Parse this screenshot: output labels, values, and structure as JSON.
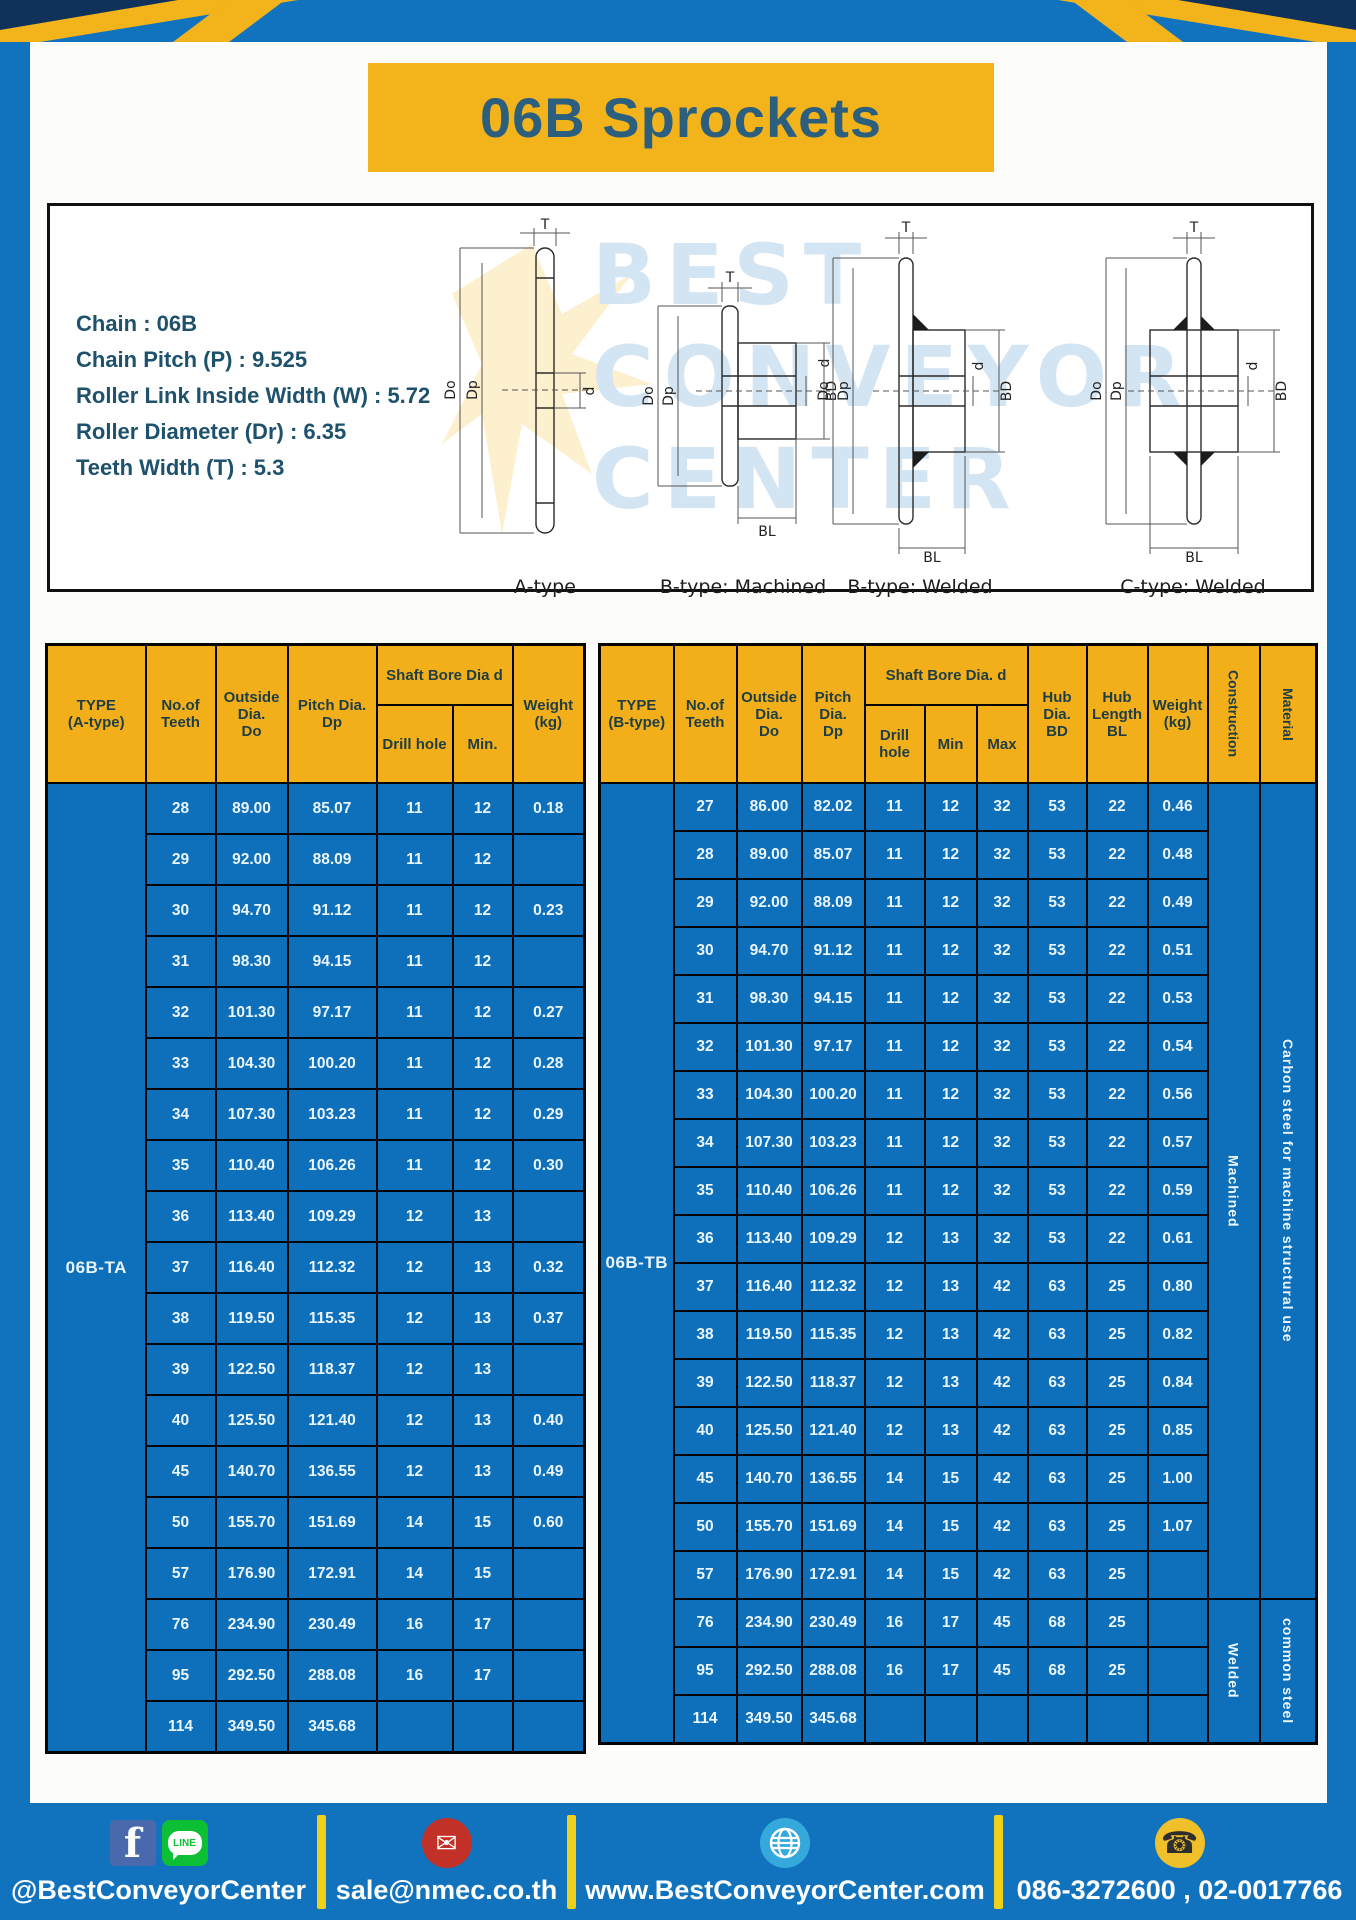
{
  "page": {
    "title": "06B Sprockets"
  },
  "specs": {
    "lines": [
      "Chain  : 06B",
      "Chain Pitch (P)  :  9.525",
      "Roller Link Inside Width (W)  :  5.72",
      "Roller Diameter (Dr)  : 6.35",
      "Teeth Width (T)  :  5.3"
    ]
  },
  "watermark": {
    "line1": "BEST",
    "line2": "CONVEYOR",
    "line3": "CENTER"
  },
  "diagrams": [
    {
      "caption": "A-type",
      "labels": {
        "T": "T",
        "Do": "Do",
        "Dp": "Dp",
        "d": "d"
      }
    },
    {
      "caption": "B-type: Machined",
      "labels": {
        "T": "T",
        "Do": "Do",
        "Dp": "Dp",
        "d": "d",
        "BD": "BD",
        "BL": "BL"
      }
    },
    {
      "caption": "B-type: Welded",
      "labels": {
        "T": "T",
        "Do": "Do",
        "Dp": "Dp",
        "d": "d",
        "BD": "BD",
        "BL": "BL"
      }
    },
    {
      "caption": "C-type: Welded",
      "labels": {
        "T": "T",
        "Do": "Do",
        "Dp": "Dp",
        "d": "d",
        "BD": "BD",
        "BL": "BL"
      }
    }
  ],
  "tables": {
    "a": {
      "headers": {
        "type": "TYPE\n(A-type)",
        "teeth": "No.of\nTeeth",
        "outside": "Outside\nDia.\nDo",
        "pitch": "Pitch Dia.\nDp",
        "shaft_group": "Shaft Bore Dia d",
        "drill": "Drill hole",
        "min": "Min.",
        "weight": "Weight\n(kg)"
      },
      "type_label": "06B-TA",
      "rows": [
        [
          "28",
          "89.00",
          "85.07",
          "11",
          "12",
          "0.18"
        ],
        [
          "29",
          "92.00",
          "88.09",
          "11",
          "12",
          ""
        ],
        [
          "30",
          "94.70",
          "91.12",
          "11",
          "12",
          "0.23"
        ],
        [
          "31",
          "98.30",
          "94.15",
          "11",
          "12",
          ""
        ],
        [
          "32",
          "101.30",
          "97.17",
          "11",
          "12",
          "0.27"
        ],
        [
          "33",
          "104.30",
          "100.20",
          "11",
          "12",
          "0.28"
        ],
        [
          "34",
          "107.30",
          "103.23",
          "11",
          "12",
          "0.29"
        ],
        [
          "35",
          "110.40",
          "106.26",
          "11",
          "12",
          "0.30"
        ],
        [
          "36",
          "113.40",
          "109.29",
          "12",
          "13",
          ""
        ],
        [
          "37",
          "116.40",
          "112.32",
          "12",
          "13",
          "0.32"
        ],
        [
          "38",
          "119.50",
          "115.35",
          "12",
          "13",
          "0.37"
        ],
        [
          "39",
          "122.50",
          "118.37",
          "12",
          "13",
          ""
        ],
        [
          "40",
          "125.50",
          "121.40",
          "12",
          "13",
          "0.40"
        ],
        [
          "45",
          "140.70",
          "136.55",
          "12",
          "13",
          "0.49"
        ],
        [
          "50",
          "155.70",
          "151.69",
          "14",
          "15",
          "0.60"
        ],
        [
          "57",
          "176.90",
          "172.91",
          "14",
          "15",
          ""
        ],
        [
          "76",
          "234.90",
          "230.49",
          "16",
          "17",
          ""
        ],
        [
          "95",
          "292.50",
          "288.08",
          "16",
          "17",
          ""
        ],
        [
          "114",
          "349.50",
          "345.68",
          "",
          "",
          ""
        ]
      ]
    },
    "b": {
      "headers": {
        "type": "TYPE\n(B-type)",
        "teeth": "No.of\nTeeth",
        "outside": "Outside\nDia.\nDo",
        "pitch": "Pitch\nDia.\nDp",
        "shaft_group": "Shaft Bore Dia. d",
        "drill": "Drill hole",
        "min": "Min",
        "max": "Max",
        "hub_dia": "Hub\nDia.\nBD",
        "hub_len": "Hub\nLength\nBL",
        "weight": "Weight\n(kg)",
        "construction": "Construction",
        "material": "Material"
      },
      "type_label": "06B-TB",
      "rows": [
        [
          "27",
          "86.00",
          "82.02",
          "11",
          "12",
          "32",
          "53",
          "22",
          "0.46"
        ],
        [
          "28",
          "89.00",
          "85.07",
          "11",
          "12",
          "32",
          "53",
          "22",
          "0.48"
        ],
        [
          "29",
          "92.00",
          "88.09",
          "11",
          "12",
          "32",
          "53",
          "22",
          "0.49"
        ],
        [
          "30",
          "94.70",
          "91.12",
          "11",
          "12",
          "32",
          "53",
          "22",
          "0.51"
        ],
        [
          "31",
          "98.30",
          "94.15",
          "11",
          "12",
          "32",
          "53",
          "22",
          "0.53"
        ],
        [
          "32",
          "101.30",
          "97.17",
          "11",
          "12",
          "32",
          "53",
          "22",
          "0.54"
        ],
        [
          "33",
          "104.30",
          "100.20",
          "11",
          "12",
          "32",
          "53",
          "22",
          "0.56"
        ],
        [
          "34",
          "107.30",
          "103.23",
          "11",
          "12",
          "32",
          "53",
          "22",
          "0.57"
        ],
        [
          "35",
          "110.40",
          "106.26",
          "11",
          "12",
          "32",
          "53",
          "22",
          "0.59"
        ],
        [
          "36",
          "113.40",
          "109.29",
          "12",
          "13",
          "32",
          "53",
          "22",
          "0.61"
        ],
        [
          "37",
          "116.40",
          "112.32",
          "12",
          "13",
          "42",
          "63",
          "25",
          "0.80"
        ],
        [
          "38",
          "119.50",
          "115.35",
          "12",
          "13",
          "42",
          "63",
          "25",
          "0.82"
        ],
        [
          "39",
          "122.50",
          "118.37",
          "12",
          "13",
          "42",
          "63",
          "25",
          "0.84"
        ],
        [
          "40",
          "125.50",
          "121.40",
          "12",
          "13",
          "42",
          "63",
          "25",
          "0.85"
        ],
        [
          "45",
          "140.70",
          "136.55",
          "14",
          "15",
          "42",
          "63",
          "25",
          "1.00"
        ],
        [
          "50",
          "155.70",
          "151.69",
          "14",
          "15",
          "42",
          "63",
          "25",
          "1.07"
        ],
        [
          "57",
          "176.90",
          "172.91",
          "14",
          "15",
          "42",
          "63",
          "25",
          ""
        ],
        [
          "76",
          "234.90",
          "230.49",
          "16",
          "17",
          "45",
          "68",
          "25",
          ""
        ],
        [
          "95",
          "292.50",
          "288.08",
          "16",
          "17",
          "45",
          "68",
          "25",
          ""
        ],
        [
          "114",
          "349.50",
          "345.68",
          "",
          "",
          "",
          "",
          "",
          ""
        ]
      ],
      "construction": [
        {
          "label": "Machined",
          "span": 17
        },
        {
          "label": "Welded",
          "span": 3
        }
      ],
      "material": [
        {
          "label": "Carbon  steel  for  machine  structural  use",
          "span": 17
        },
        {
          "label": "common steel",
          "span": 3
        }
      ]
    }
  },
  "footer": {
    "items": [
      {
        "label": "@BestConveyorCenter"
      },
      {
        "label": "sale@nmec.co.th"
      },
      {
        "label": "www.BestConveyorCenter.com"
      },
      {
        "label": "086-3272600 , 02-0017766"
      }
    ],
    "glyphs": {
      "facebook": "f",
      "line": "LINE",
      "mail": "✉",
      "phone": "☎"
    }
  },
  "colors": {
    "page_blue": "#1173BD",
    "cell_blue": "#0E6FBA",
    "header_yellow": "#F3AF19",
    "title_yellow": "#F3B31B",
    "title_text": "#2B5F7D",
    "divider_yellow": "#EFD11C",
    "facebook_blue": "#4A69AD",
    "line_green": "#0DBF34",
    "mail_red": "#C23127",
    "globe_blue": "#35A8DC",
    "phone_yellow": "#F0C02A"
  }
}
